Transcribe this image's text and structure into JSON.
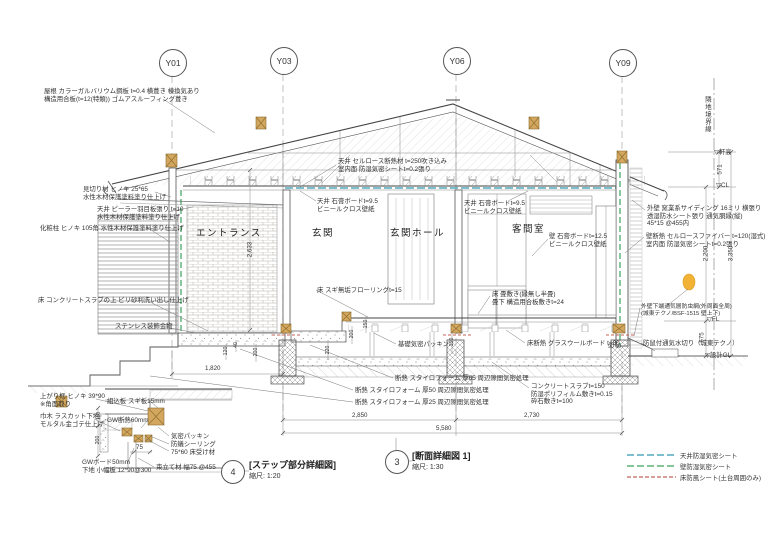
{
  "grid": {
    "markers": [
      {
        "label": "Y01"
      },
      {
        "label": "Y03"
      },
      {
        "label": "Y06"
      },
      {
        "label": "Y09"
      }
    ]
  },
  "rooms": {
    "entrance": "エントランス",
    "genkan": "玄関",
    "genkan_hall": "玄関ホール",
    "kyakuma": "客間室"
  },
  "annotations": {
    "roof": "屋根 カラーガルバリウム鋼板 t=0.4  横葺き 棟換気あり\n構造用合板(t=12(特類))  ゴムアスルーフィング葺き",
    "mikiri": "見切り材 ヒノキ 25*65\n水性木材保護塗料塗り仕上げ",
    "ceiling_peeler": "天井 ピーラー羽目板張り t=10\n水性木材保護塗料塗り仕上げ",
    "kesho_bashira": "化粧柱 ヒノキ 105角  水性木材保護塗料塗り仕上げ",
    "floor_washout": "床 コンクリートスラブの上  ビリ砂利洗い出し仕上げ",
    "stainless": "ステンレス装飾金物",
    "ceiling_cellulose": "天井 セルロース断熱材 t=250吹き込み\n室内面 防湿気密シートt=0.2張り",
    "ceiling_gypsum_l": "天井 石膏ボードt=9.5\nビニールクロス壁紙",
    "ceiling_gypsum_r": "天井 石膏ボードt=9.5\nビニールクロス壁紙",
    "wall_gypsum": "壁 石膏ボードt=12.5\nビニールクロス壁紙",
    "floor_sugi": "床 スギ無垢フローリングt=15",
    "floor_tatami": "床 畳敷き(縁無し半畳)\n畳下 構造用合板敷きt=24",
    "kiso_packing": "基礎気密パッキン",
    "floor_gw": "床断熱 グラスウールボード t=80",
    "insul_65": "断熱 スタイロフォーム 厚65 周辺隙間気密処理",
    "insul_50": "断熱 スタイロフォーム 厚50 周辺隙間気密処理",
    "insul_25": "断熱 スタイロフォーム 厚25 周辺隙間気密処理",
    "slab": "コンクリートスラブt=150\n防湿ポリフィルム敷きt=0.15\n砕石敷きt=100",
    "gaiheki": "外壁 窯業系サイディング 16ミリ 横張り\n透湿防水シート張り 通気胴縁(縦)\n45*15 @455内",
    "kabe_dannetsu": "壁断熱 セルロースファイバー t=120(湿式)\n室内面 防湿気密シートt=0.2張り",
    "gaiheki_bouchuumou": "外壁下端通気層防虫網(外周面全周)\n(城東テクノ/BSF-1515 壁上下)",
    "mizukiri": "防鼠付通気水切り（城東テクノ）",
    "agarikamachi": "上がり框 ヒノキ 39*90\n※角面取り",
    "habaki": "巾木 ラスカット下地\nモルタル金ゴテ仕上げ",
    "kumikomi": "組込板 スギ板15mm",
    "gw_insul": "GW断熱60mm",
    "kimitsu_packing": "気密パッキン",
    "bougi_sealing": "防蟻シーリング",
    "yuka_uke": "75*60 床受け材",
    "gw_board": "GWボード50mm\n下地 小幅板 12*90@300",
    "tsuka": "束立て材 幅75 @455"
  },
  "levels": {
    "nokidaka": "▽軒高",
    "cl": "▽CL",
    "fl": "▽FL",
    "gl": "▽設計GL",
    "boundary": "隣地境界線"
  },
  "dims": {
    "d571": "571",
    "d2200": "2,200",
    "d3350": "3,350",
    "d575": "575",
    "d2633": "2,633",
    "d1820": "1,820",
    "d2850": "2,850",
    "d2730": "2,730",
    "d5580": "5,580",
    "d120": "120",
    "d40": "40",
    "d200": "200",
    "d150": "150",
    "d200b": "200",
    "d220": "220",
    "d150b": "150",
    "d110": "110",
    "d200c": "200",
    "d75": "75",
    "d90_60": "90  60"
  },
  "titles": {
    "detail4_num": "4",
    "detail4_name": "[ステップ部分詳細図]",
    "detail4_scale": "縮尺: 1:20",
    "detail3_num": "3",
    "detail3_name": "[断面詳細図 1]",
    "detail3_scale": "縮尺: 1:30"
  },
  "legend": {
    "items": [
      {
        "label": "天井防湿気密シート",
        "color": "#2e9bb0"
      },
      {
        "label": "壁防湿気密シート",
        "color": "#3aa35a"
      },
      {
        "label": "床防風シート(土台周囲のみ)",
        "color": "#c4635a"
      }
    ]
  },
  "colors": {
    "ceiling_sheet": "#2e9bb0",
    "wall_sheet": "#3aa35a",
    "floor_sheet": "#c4635a",
    "wood_member": "#d3a85e",
    "vent_marker": "#f2b235"
  }
}
